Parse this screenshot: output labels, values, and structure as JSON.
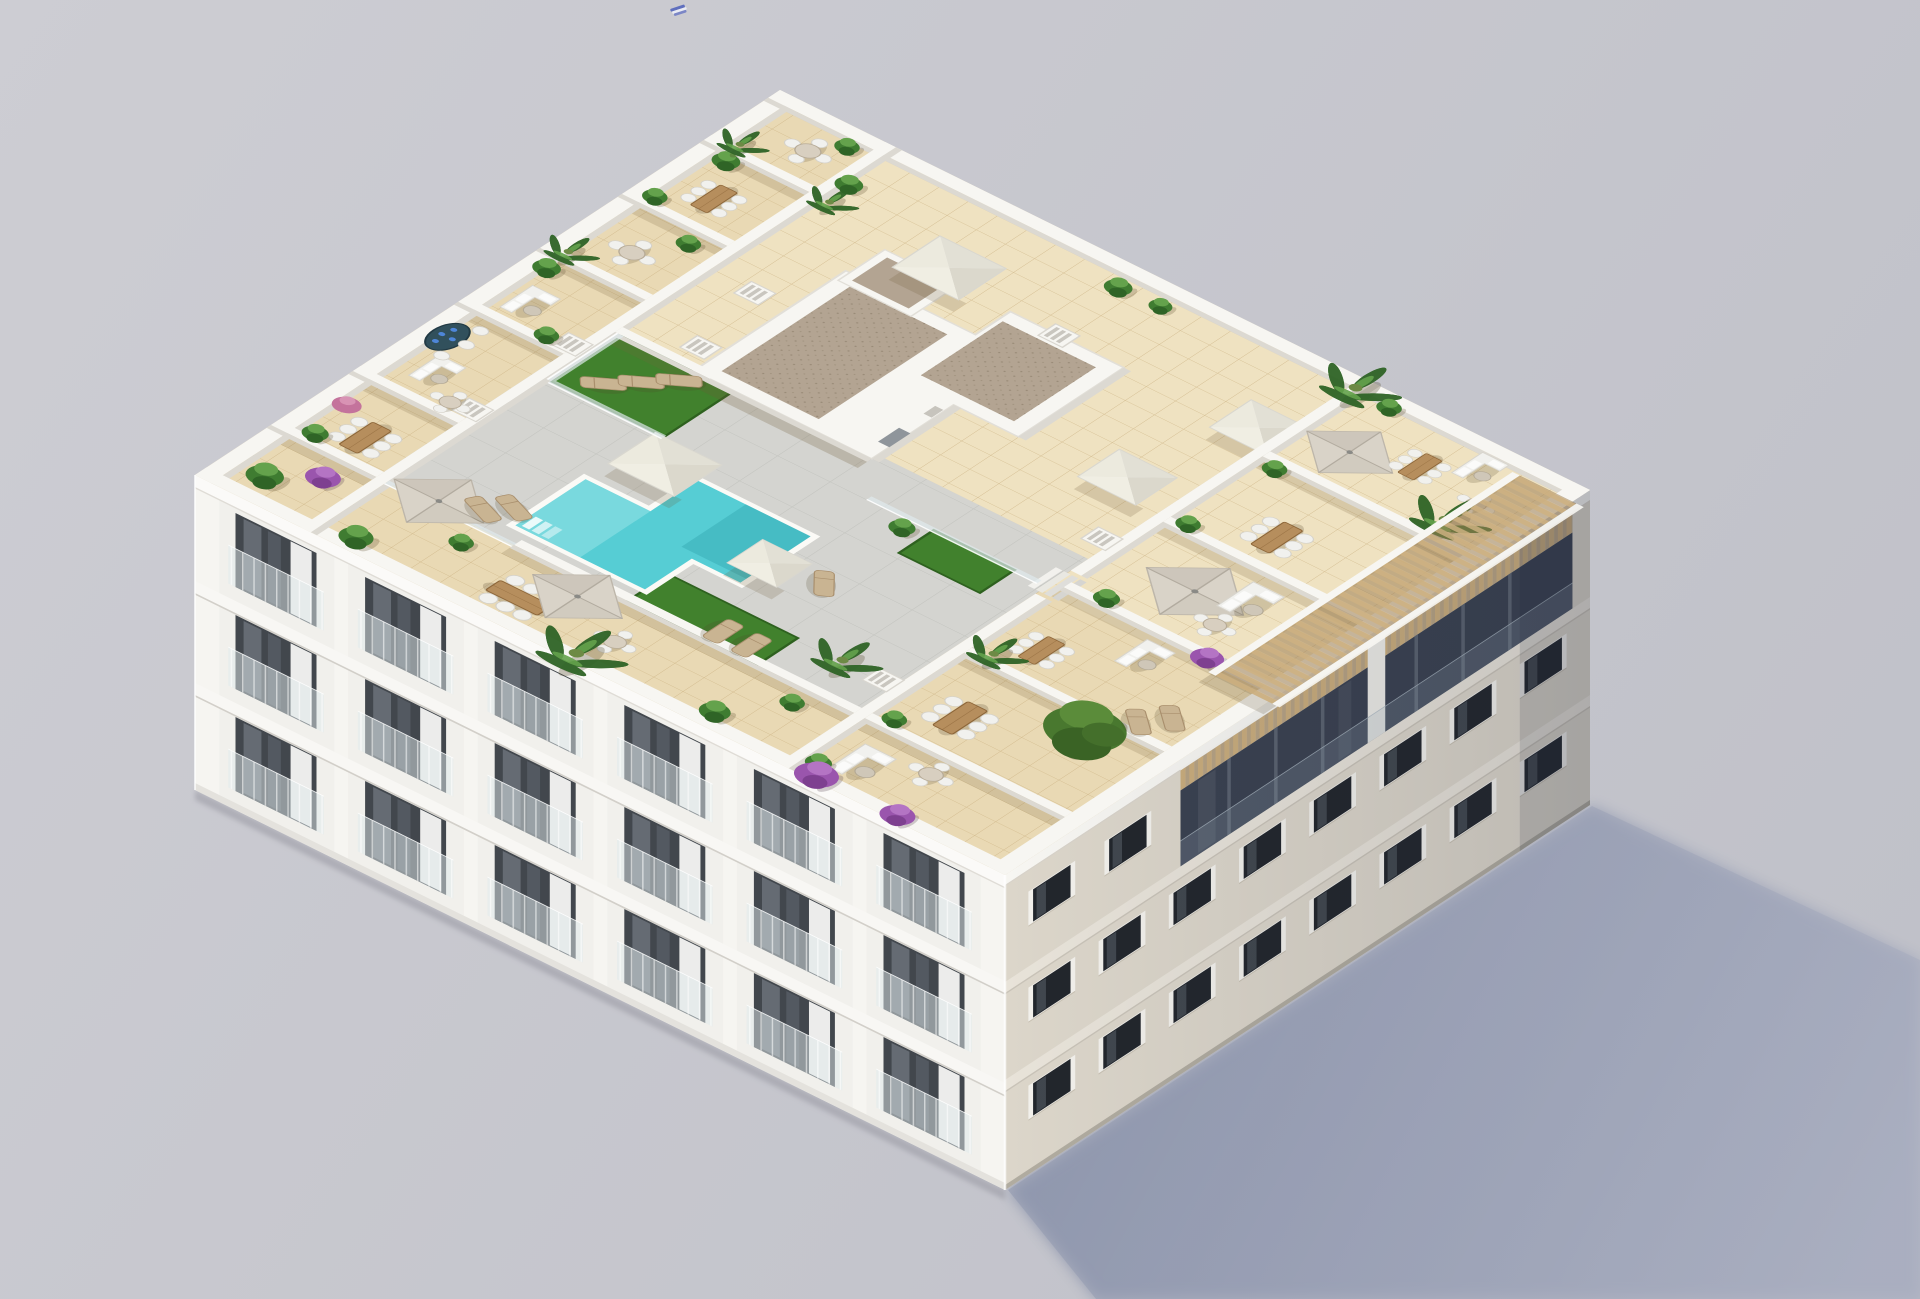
{
  "scene": {
    "title": "Aerial 3D architectural render of an apartment building rooftop",
    "description": "Axonometric aerial rendering of a white residential apartment block. The rooftop holds a communal turquoise swimming pool on a grey sun deck, artificial turf with sun loungers, pyramid skylights, a gravel-topped stair core, a slatted wood pergola along the right edge, and many private terraces furnished with parasols, outdoor sofas, dining sets, potted plants, palms and purple bougainvillea. Two facades are visible: a white balcony facade on the left and a beige punched-window facade on the right. The building casts a long blue-grey shadow to the lower right on a plain grey ground. A tiny bird flies in the sky.",
    "background": "plain light grey studio ground",
    "bird": "small flying bird"
  },
  "building": {
    "facades": {
      "southwest": "white facade with three floors of balconies, dark glazed openings, curtains and glass balustrades",
      "southeast": "warm beige facade with punched dark windows and a recessed glazed top floor under a slatted timber pergola"
    }
  },
  "rooftop": {
    "features": [
      "swimming-pool",
      "pool-deck",
      "artificial-turf",
      "sun-loungers",
      "parasols",
      "outdoor-sofas",
      "dining-sets",
      "round-tables",
      "spa-table",
      "pyramid-skylights",
      "stair-core-gravel-roof",
      "timber-pergola",
      "glass-balustrades",
      "white-privacy-walls",
      "chimneys",
      "potted-plants",
      "palm-trees",
      "bougainvillea",
      "olive-tree",
      "access-steps"
    ]
  },
  "palette": {
    "bg1": "#cdcdd3",
    "bg2": "#bfc0c8",
    "shadow1": "#8d95ac",
    "shadow2": "#a9aec0",
    "contact": "#9c9ca6",
    "tile": "#e9d9b4",
    "tileLine": "#c9ae7e",
    "tileLight": "#f3e8ca",
    "deck": "#d4d4d0",
    "deckLine": "#c2c3be",
    "pool": "#56cdd4",
    "poolLight": "#97e4e6",
    "poolDeep": "#2fa3ad",
    "turf": "#41812d",
    "turfDark": "#2e611f",
    "wall": "#f7f6f2",
    "wallFace": "#dcd9d2",
    "gravel": "#b3a492",
    "gravelDot": "#8f816c",
    "slat": "#c9ac7c",
    "slatDark": "#9c7f54",
    "umbrella": "#d9d3c8",
    "umbrellaDark": "#c3bcb0",
    "wood": "#b68e5d",
    "woodDark": "#8d6639",
    "furn": "#f1f1ee",
    "lounger": "#c9b492",
    "pot": "#c8b9a2",
    "green1": "#3f7c31",
    "green2": "#64a24c",
    "green3": "#2f6426",
    "purple": "#9a55ad",
    "pink": "#c4739c",
    "treeG": "#49782f",
    "spa": "#31505c",
    "facadeSW": "#f1f0ec",
    "facadeSE": "#dcd6ca",
    "openingDark": "#42474d",
    "recess": "#3a4150",
    "mullion": "#5a626f",
    "winDark": "#22262c",
    "frame": "#f3f1ec",
    "glass": "#dfeaec",
    "birdBlue": "#5f6fbe"
  }
}
